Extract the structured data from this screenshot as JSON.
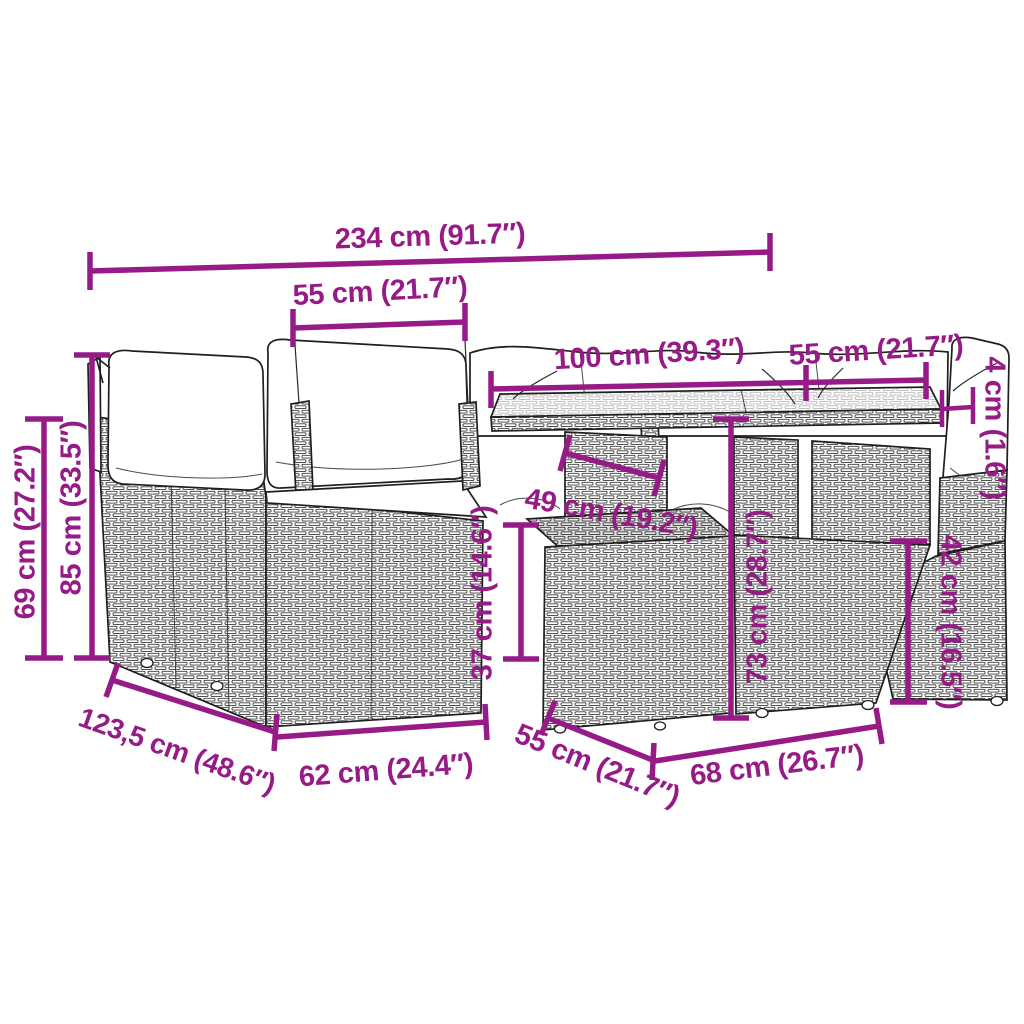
{
  "meta": {
    "accent_color": "#961b87",
    "line_color": "#1f1f1f",
    "background_color": "#ffffff"
  },
  "labels": {
    "total_width": "234 cm (91.7″)",
    "seat_width_top": "55 cm (21.7″)",
    "table_length": "100 cm (39.3″)",
    "right_module_width": "55 cm (21.7″)",
    "glass_thickness": "4 cm (1.6″)",
    "seat_height": "69 cm (27.2″)",
    "back_height": "85 cm (33.5″)",
    "table_inner_width": "49 cm (19.2″)",
    "footstool_height": "37 cm (14.6″)",
    "table_height": "73 cm (28.7″)",
    "side_seat_height": "42 cm (16.5″)",
    "total_depth": "123,5 cm (48.6″)",
    "seat_module_width": "62 cm (24.4″)",
    "footstool_depth": "55 cm (21.7″)",
    "table_depth": "68 cm (26.7″)"
  }
}
